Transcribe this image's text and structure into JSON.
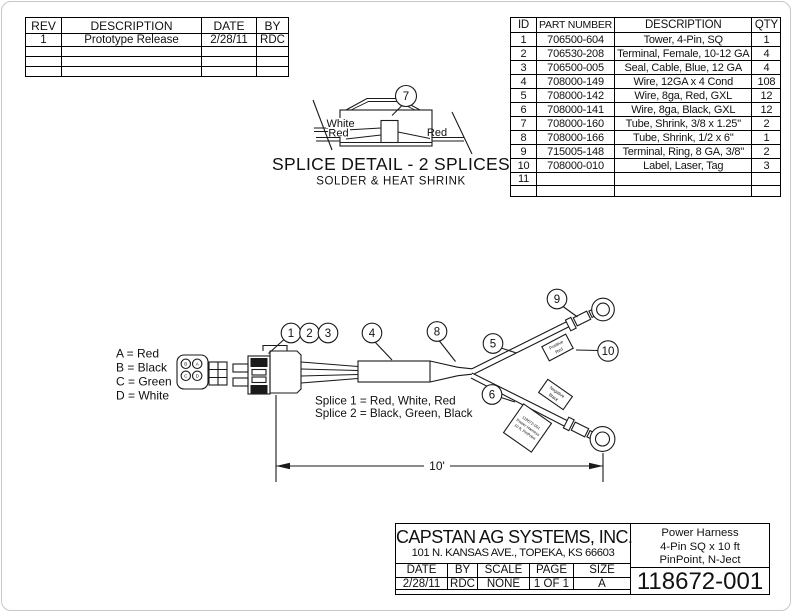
{
  "revision_table": {
    "headers": [
      "REV",
      "DESCRIPTION",
      "DATE",
      "BY"
    ],
    "rows": [
      [
        "1",
        "Prototype Release",
        "2/28/11",
        "RDC"
      ],
      [
        "",
        "",
        "",
        ""
      ],
      [
        "",
        "",
        "",
        ""
      ],
      [
        "",
        "",
        "",
        ""
      ]
    ]
  },
  "parts_table": {
    "headers": [
      "ID",
      "PART NUMBER",
      "DESCRIPTION",
      "QTY"
    ],
    "rows": [
      [
        "1",
        "706500-604",
        "Tower, 4-Pin, SQ",
        "1"
      ],
      [
        "2",
        "706530-208",
        "Terminal, Female, 10-12 GA",
        "4"
      ],
      [
        "3",
        "706500-005",
        "Seal, Cable, Blue, 12 GA",
        "4"
      ],
      [
        "4",
        "708000-149",
        "Wire, 12GA x 4 Cond",
        "108"
      ],
      [
        "5",
        "708000-142",
        "Wire, 8ga, Red, GXL",
        "12"
      ],
      [
        "6",
        "708000-141",
        "Wire, 8ga, Black, GXL",
        "12"
      ],
      [
        "7",
        "708000-160",
        "Tube, Shrink, 3/8 x 1.25\"",
        "2"
      ],
      [
        "8",
        "708000-166",
        "Tube, Shrink, 1/2 x 6\"",
        "1"
      ],
      [
        "9",
        "715005-148",
        "Terminal, Ring, 8 GA, 3/8\"",
        "2"
      ],
      [
        "10",
        "708000-010",
        "Label, Laser, Tag",
        "3"
      ],
      [
        "11",
        "",
        "",
        ""
      ],
      [
        "",
        "",
        "",
        ""
      ]
    ]
  },
  "splice_detail": {
    "callout": "7",
    "label_left_top": "White",
    "label_left_bottom": "Red",
    "label_right": "Red",
    "title": "SPLICE DETAIL - 2 SPLICES",
    "subtitle": "SOLDER & HEAT SHRINK"
  },
  "wire_legend": [
    "A = Red",
    "B = Black",
    "C = Green",
    "D = White"
  ],
  "connector_pins": {
    "top_left": "B",
    "top_right": "A",
    "bottom_left": "C",
    "bottom_right": "D"
  },
  "callouts": {
    "c1": "1",
    "c2": "2",
    "c3": "3",
    "c4": "4",
    "c5": "5",
    "c6": "6",
    "c8": "8",
    "c9": "9",
    "c10": "10"
  },
  "splice_notes": [
    "Splice 1 = Red, White, Red",
    "Splice 2 = Black, Green, Black"
  ],
  "tags": {
    "positive": [
      "Positive",
      "Red"
    ],
    "negative": [
      "Negative",
      "Black"
    ],
    "info": [
      "118672-001",
      "Power Harness",
      "10 ft, PinPoint"
    ]
  },
  "dimension_label": "10'",
  "title_block": {
    "company": "CAPSTAN AG SYSTEMS, INC.",
    "address": "101 N. KANSAS AVE., TOPEKA, KS 66603",
    "product": [
      "Power Harness",
      "4-Pin SQ x 10 ft",
      "PinPoint, N-Ject"
    ],
    "part_number": "118672-001",
    "field_headers": [
      "DATE",
      "BY",
      "SCALE",
      "PAGE",
      "SIZE"
    ],
    "field_values": [
      "2/28/11",
      "RDC",
      "NONE",
      "1 OF 1",
      "A"
    ]
  }
}
